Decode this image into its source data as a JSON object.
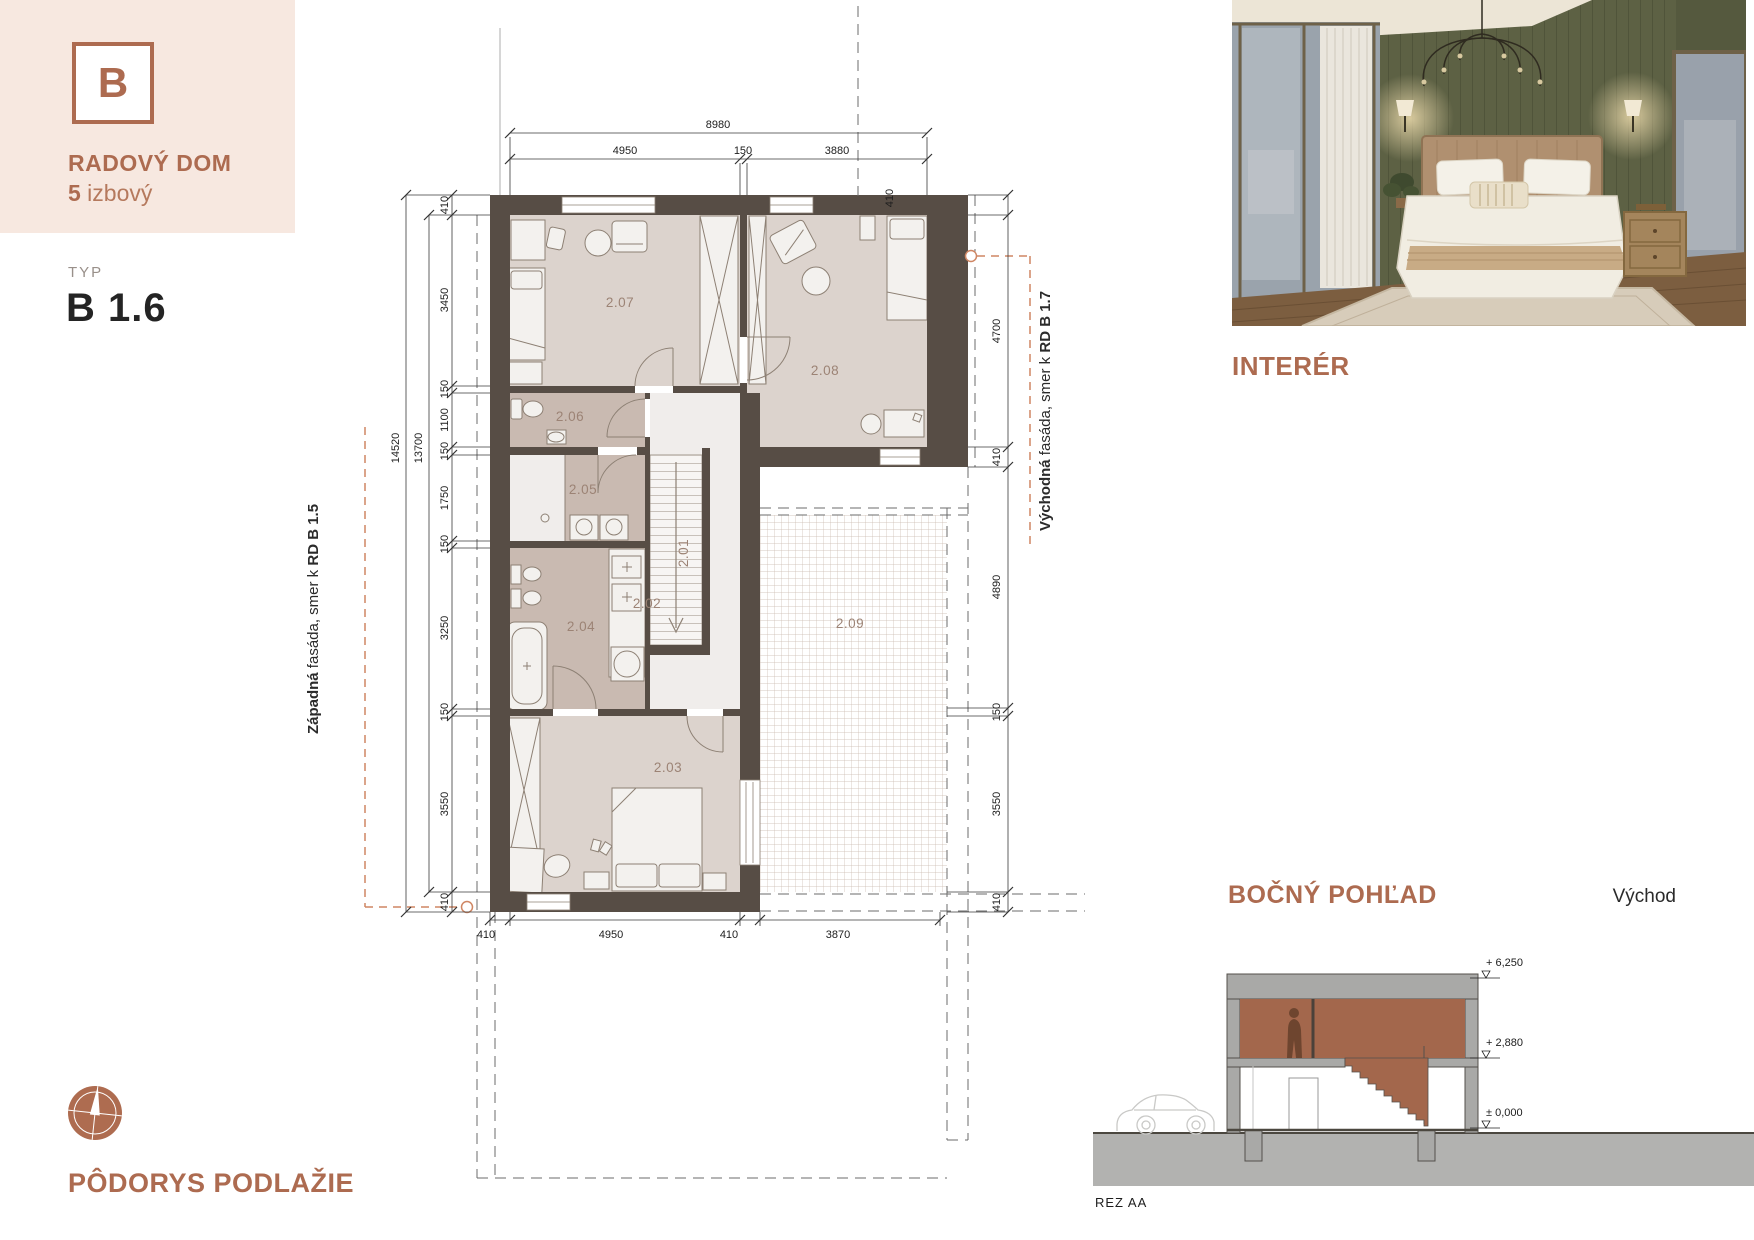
{
  "brand": {
    "letter": "B",
    "title": "RADOVÝ DOM",
    "rooms_count": "5",
    "rooms_text": " izbový",
    "typ_label": "TYP",
    "typ_value": "B 1.6"
  },
  "plan": {
    "caption": "PÔDORYS PODLAŽIE",
    "rooms": [
      {
        "id": "2.01"
      },
      {
        "id": "2.02"
      },
      {
        "id": "2.03"
      },
      {
        "id": "2.04"
      },
      {
        "id": "2.05"
      },
      {
        "id": "2.06"
      },
      {
        "id": "2.07"
      },
      {
        "id": "2.08"
      },
      {
        "id": "2.09"
      }
    ],
    "dims": {
      "top_total": "8980",
      "top": [
        "4950",
        "150",
        "3880"
      ],
      "left_overall": "14520",
      "left_inner": "13700",
      "left": [
        "410",
        "3450",
        "150",
        "1100",
        "150",
        "1750",
        "150",
        "3250",
        "150",
        "3550",
        "410"
      ],
      "right": [
        "410",
        "4700",
        "410",
        "4890",
        "150",
        "3550",
        "410"
      ],
      "bottom": [
        "410",
        "4950",
        "410",
        "3870"
      ]
    },
    "west_facade": {
      "lead": "Západná",
      "mid": " fasáda, smer k ",
      "target": "RD B 1.5"
    },
    "east_facade": {
      "lead": "Východná",
      "mid": " fasáda, smer k ",
      "target": "RD B 1.7"
    }
  },
  "interior": {
    "label": "INTERÉR"
  },
  "side_view": {
    "label": "BOČNÝ POHĽAD",
    "direction": "Východ",
    "caption": "REZ AA",
    "levels": [
      "+ 6,250",
      "+ 2,880",
      "± 0,000"
    ]
  },
  "colors": {
    "accent": "#ad6b50",
    "panel_bg": "#f7e8e0",
    "wall": "#574d45",
    "room_light": "#dcd3cd",
    "room_dark": "#c9bab1",
    "orange_dash": "#cf8663",
    "section_fill": "#a3674c"
  }
}
